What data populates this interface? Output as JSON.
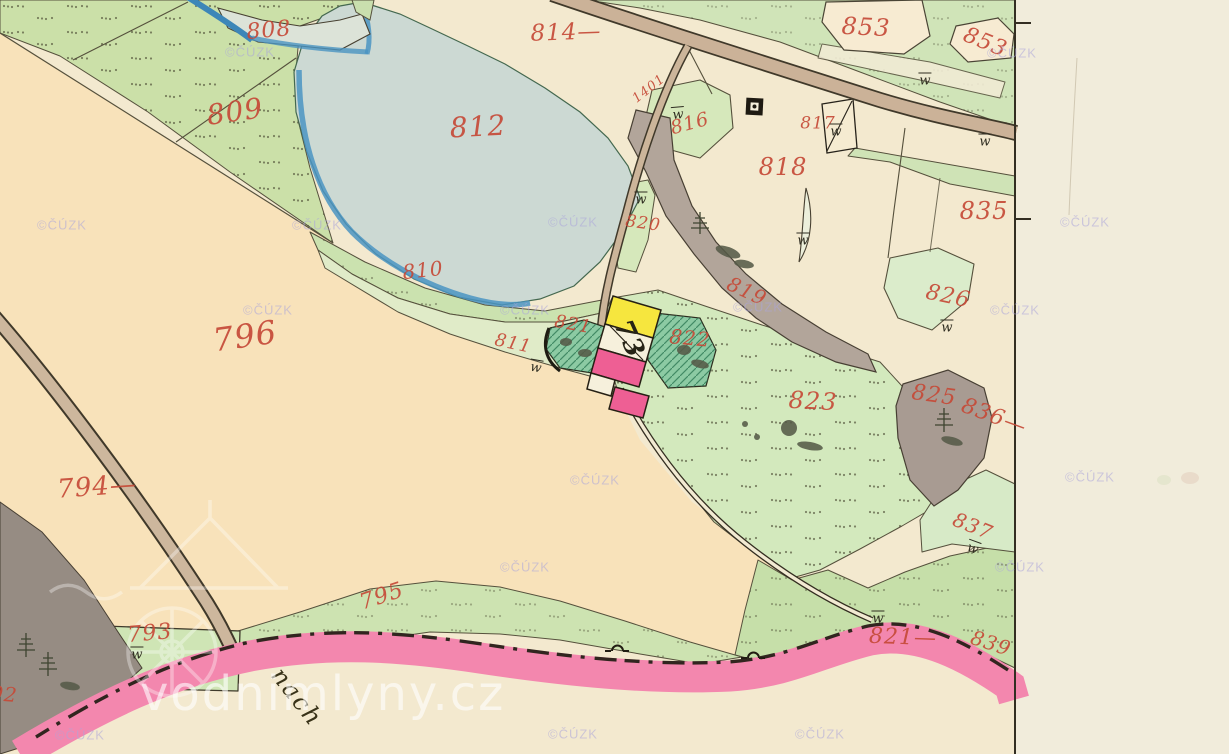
{
  "map_type": "historical-cadastral-map",
  "colors": {
    "parcel_number_red": "#c64a38",
    "ink_black": "#262316",
    "pond_fill": "#ccd9d3",
    "pond_edge_blue": "#4a94c2",
    "meadow_green": "#d3e9bd",
    "field_peach": "#f8e2ba",
    "road_pink": "#f387ae",
    "road_tan": "#cbb298",
    "building_masonry_pink": "#ee5f94",
    "building_wood_yellow": "#f6e63e",
    "forest_gray": "#b2a59a",
    "paper_cream": "#f1ecdb"
  },
  "labels": [
    {
      "t": "808",
      "x": 269,
      "y": 31,
      "s": 22,
      "r": -5,
      "c": "red"
    },
    {
      "t": "809",
      "x": 235,
      "y": 112,
      "s": 28,
      "r": -8,
      "c": "red"
    },
    {
      "t": "812",
      "x": 478,
      "y": 127,
      "s": 28,
      "r": -3,
      "c": "red"
    },
    {
      "t": "814—",
      "x": 566,
      "y": 33,
      "s": 23,
      "r": -2,
      "c": "red"
    },
    {
      "t": "816",
      "x": 690,
      "y": 124,
      "s": 19,
      "r": -15,
      "c": "red"
    },
    {
      "t": "817",
      "x": 818,
      "y": 124,
      "s": 17,
      "r": 0,
      "c": "red"
    },
    {
      "t": "818",
      "x": 783,
      "y": 167,
      "s": 24,
      "r": 0,
      "c": "red"
    },
    {
      "t": "819",
      "x": 747,
      "y": 291,
      "s": 20,
      "r": 25,
      "c": "red"
    },
    {
      "t": "820",
      "x": 643,
      "y": 224,
      "s": 17,
      "r": 8,
      "c": "red"
    },
    {
      "t": "810",
      "x": 423,
      "y": 270,
      "s": 20,
      "r": -6,
      "c": "red"
    },
    {
      "t": "811",
      "x": 513,
      "y": 344,
      "s": 18,
      "r": 12,
      "c": "red"
    },
    {
      "t": "821",
      "x": 573,
      "y": 325,
      "s": 18,
      "r": 10,
      "c": "red"
    },
    {
      "t": "822",
      "x": 690,
      "y": 338,
      "s": 20,
      "r": 5,
      "c": "red"
    },
    {
      "t": "823",
      "x": 813,
      "y": 401,
      "s": 24,
      "r": 3,
      "c": "red"
    },
    {
      "t": "825",
      "x": 934,
      "y": 396,
      "s": 22,
      "r": 8,
      "c": "red"
    },
    {
      "t": "826",
      "x": 948,
      "y": 297,
      "s": 22,
      "r": 12,
      "c": "red"
    },
    {
      "t": "835",
      "x": 984,
      "y": 211,
      "s": 24,
      "r": 0,
      "c": "red"
    },
    {
      "t": "836—",
      "x": 994,
      "y": 417,
      "s": 22,
      "r": 20,
      "c": "red"
    },
    {
      "t": "837",
      "x": 973,
      "y": 526,
      "s": 20,
      "r": 22,
      "c": "red"
    },
    {
      "t": "853",
      "x": 866,
      "y": 27,
      "s": 24,
      "r": 3,
      "c": "red"
    },
    {
      "t": "853",
      "x": 985,
      "y": 43,
      "s": 22,
      "r": 22,
      "c": "red"
    },
    {
      "t": "793",
      "x": 150,
      "y": 634,
      "s": 22,
      "r": -5,
      "c": "red"
    },
    {
      "t": "794—",
      "x": 97,
      "y": 487,
      "s": 26,
      "r": -4,
      "c": "red"
    },
    {
      "t": "795",
      "x": 382,
      "y": 597,
      "s": 22,
      "r": -18,
      "c": "red"
    },
    {
      "t": "796",
      "x": 245,
      "y": 336,
      "s": 32,
      "r": -8,
      "c": "red"
    },
    {
      "t": "821—",
      "x": 903,
      "y": 638,
      "s": 22,
      "r": 2,
      "c": "red"
    },
    {
      "t": "839",
      "x": 991,
      "y": 643,
      "s": 20,
      "r": 18,
      "c": "red"
    },
    {
      "t": "92",
      "x": 4,
      "y": 694,
      "s": 20,
      "r": 5,
      "c": "red"
    },
    {
      "t": "73",
      "x": 629,
      "y": 339,
      "s": 26,
      "r": 66,
      "c": "ink"
    },
    {
      "t": "1401",
      "x": 649,
      "y": 89,
      "s": 13,
      "r": -38,
      "c": "red"
    },
    {
      "t": "nach",
      "x": 297,
      "y": 697,
      "s": 24,
      "r": 52,
      "c": "script"
    }
  ],
  "meadow_marks": [
    {
      "x": 925,
      "y": 80,
      "r": 0
    },
    {
      "x": 985,
      "y": 141,
      "r": 0
    },
    {
      "x": 836,
      "y": 131,
      "r": 0
    },
    {
      "x": 678,
      "y": 114,
      "r": -5
    },
    {
      "x": 641,
      "y": 199,
      "r": 0
    },
    {
      "x": 803,
      "y": 240,
      "r": 0
    },
    {
      "x": 536,
      "y": 367,
      "r": 10
    },
    {
      "x": 947,
      "y": 327,
      "r": 0
    },
    {
      "x": 973,
      "y": 548,
      "r": 20
    },
    {
      "x": 878,
      "y": 618,
      "r": 0
    },
    {
      "x": 137,
      "y": 654,
      "r": 0
    }
  ],
  "watermarks": {
    "cuzk_text": "©ČÚZK",
    "spots": [
      [
        250,
        52
      ],
      [
        1012,
        53
      ],
      [
        62,
        225
      ],
      [
        317,
        225
      ],
      [
        573,
        222
      ],
      [
        1085,
        222
      ],
      [
        268,
        310
      ],
      [
        525,
        310
      ],
      [
        758,
        307
      ],
      [
        1015,
        310
      ],
      [
        595,
        480
      ],
      [
        1090,
        477
      ],
      [
        525,
        567
      ],
      [
        1020,
        567
      ],
      [
        80,
        735
      ],
      [
        573,
        734
      ],
      [
        820,
        734
      ]
    ],
    "site_text": "vodnimlyny.cz"
  }
}
